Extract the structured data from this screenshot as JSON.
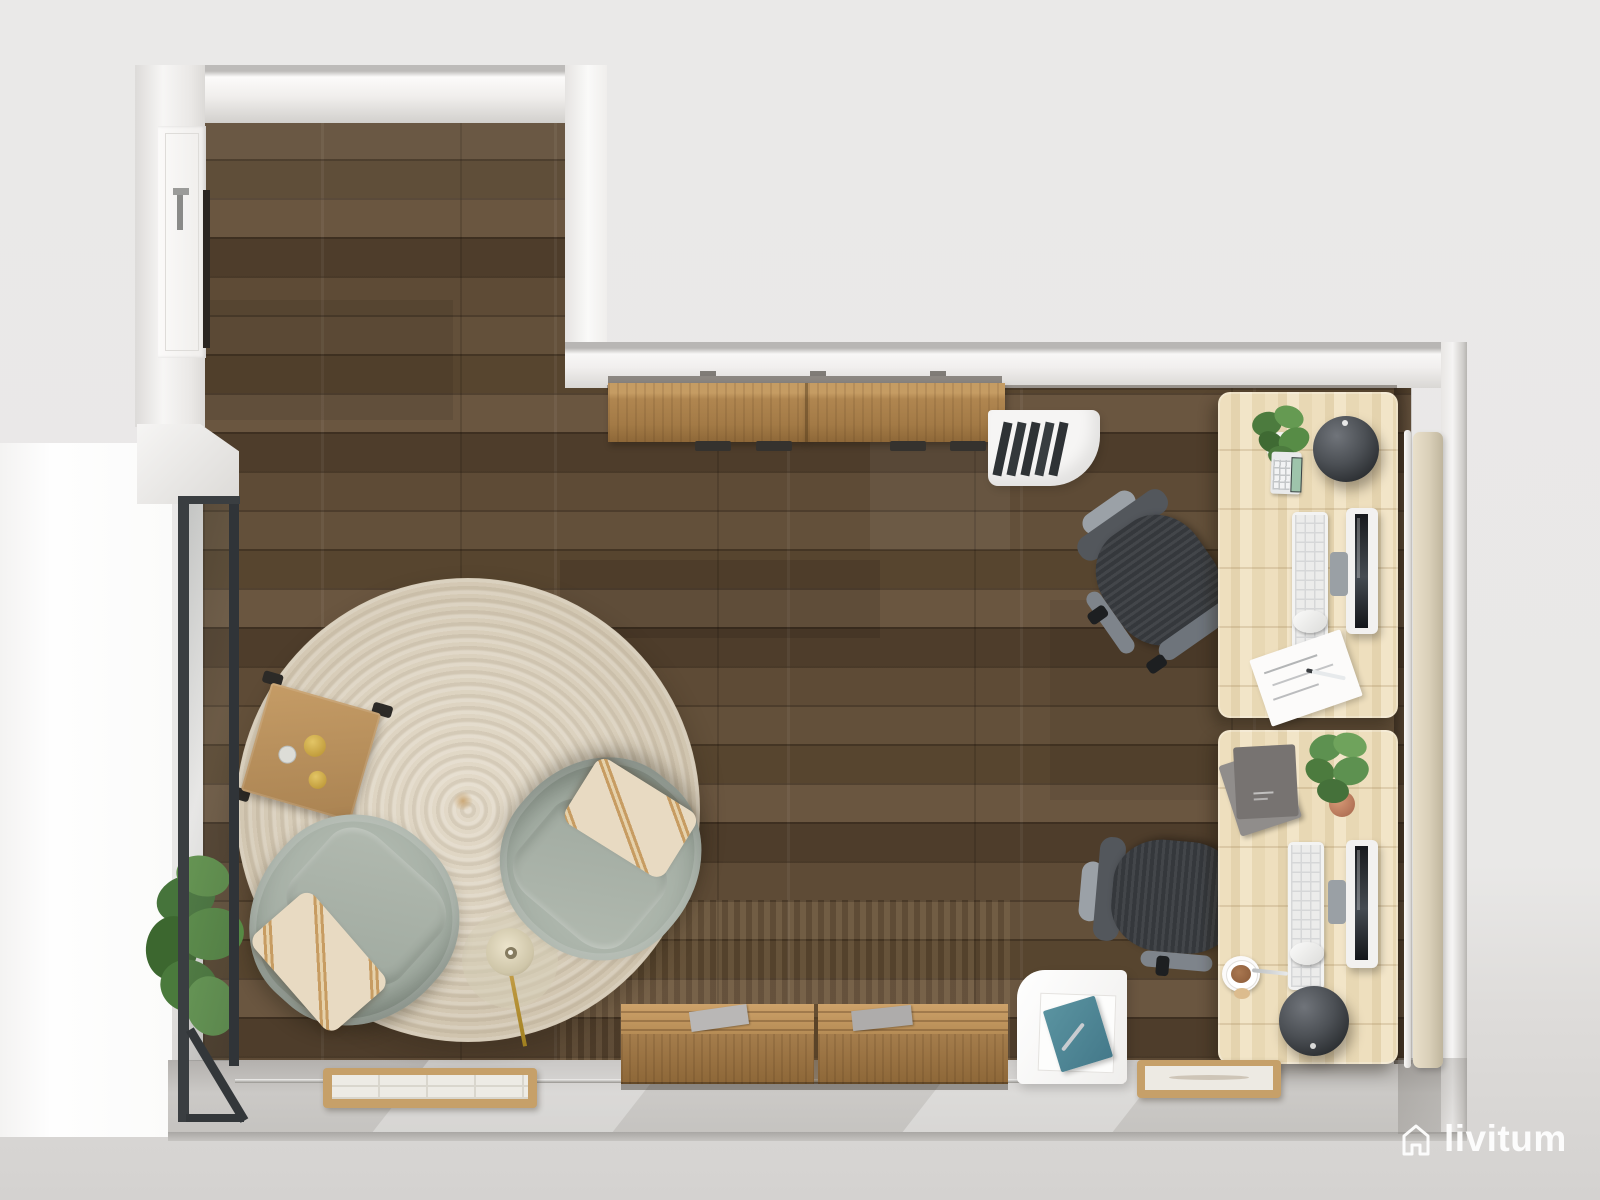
{
  "brand": {
    "watermark_text": "livitum",
    "logo_icon": "house-outline-icon",
    "text_color": "#ffffff"
  },
  "scene": {
    "description": "Top-down 3D render of an L-shaped home office with a lounge corner",
    "colors_of_note": {
      "background": "#e9e8e7",
      "wall": "#f2f1f0",
      "wood_floor": "#5a4733",
      "entry_floor": "#c7c5c2",
      "rug": "#d7cdb9",
      "armchair": "#a7b1a7",
      "pillow": "#e7d9c2",
      "desk_wood": "#e9dab9",
      "sideboard_wood": "#ab8150",
      "office_chair": "#35383c",
      "glass_frame": "#3a3e41",
      "teal_notebook": "#4d8894",
      "plant_green": "#578c46",
      "gold_decor": "#c9a33b"
    },
    "objects": [
      "entry-door",
      "glass-partition",
      "floor-plant",
      "round-jute-rug",
      "lounge-armchair-left",
      "lounge-armchair-right",
      "throw-pillows",
      "wooden-coffee-table",
      "gold-decor",
      "floor-lamp",
      "wall-sideboards-top",
      "wall-sideboards-bottom",
      "magazines",
      "white-file-organizer",
      "white-storage-cabinet",
      "teal-notebook",
      "desk-top",
      "desk-bottom",
      "office-chair-top",
      "office-chair-bottom",
      "keyboards",
      "mice",
      "monitors",
      "desk-plants",
      "decor-spheres",
      "calculator",
      "sketch-paper",
      "notebook-stack",
      "coffee-cup",
      "shoe-tray-left",
      "shoe-tray-right",
      "radiator-panel",
      "outdoor-terrace"
    ]
  }
}
